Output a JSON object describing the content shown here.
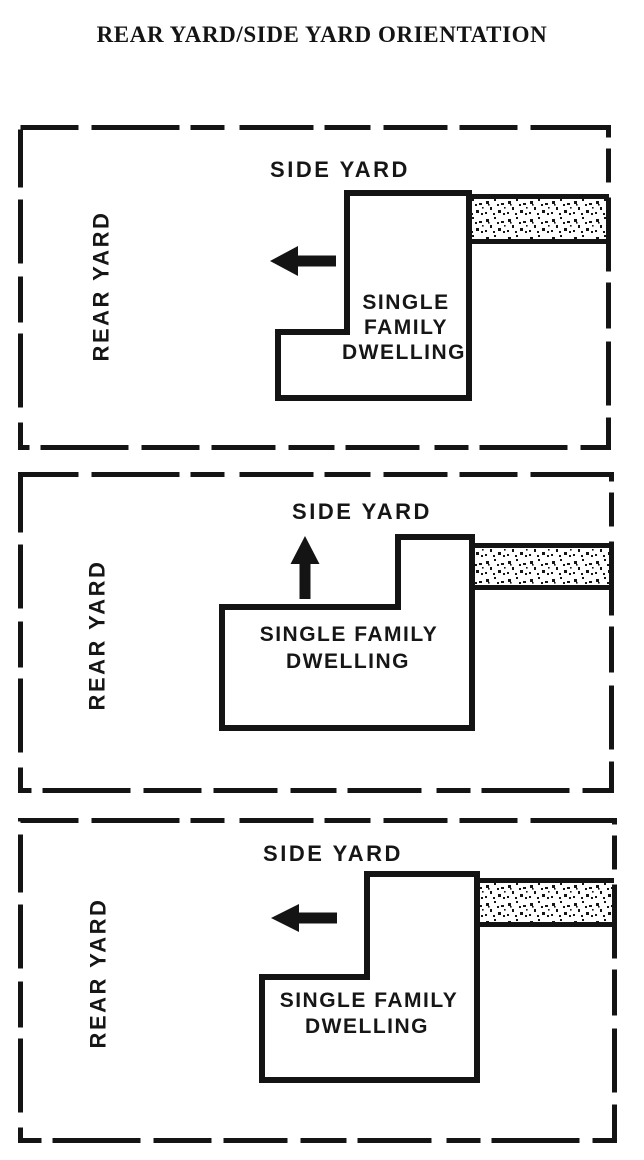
{
  "title": "REAR YARD/SIDE YARD ORIENTATION",
  "colors": {
    "ink": "#141414",
    "paper": "#ffffff"
  },
  "panels": [
    {
      "id": "top",
      "side_yard_label": "SIDE YARD",
      "rear_yard_label": "REAR YARD",
      "dwelling_lines": [
        "SINGLE",
        "FAMILY",
        "DWELLING"
      ],
      "arrow_direction": "left",
      "lot_border_style": "dashed"
    },
    {
      "id": "middle",
      "side_yard_label": "SIDE YARD",
      "rear_yard_label": "REAR YARD",
      "dwelling_lines": [
        "SINGLE FAMILY",
        "DWELLING"
      ],
      "arrow_direction": "up",
      "lot_border_style": "dashed"
    },
    {
      "id": "bottom",
      "side_yard_label": "SIDE YARD",
      "rear_yard_label": "REAR YARD",
      "dwelling_lines": [
        "SINGLE FAMILY",
        "DWELLING"
      ],
      "arrow_direction": "left",
      "lot_border_style": "dashed"
    }
  ]
}
